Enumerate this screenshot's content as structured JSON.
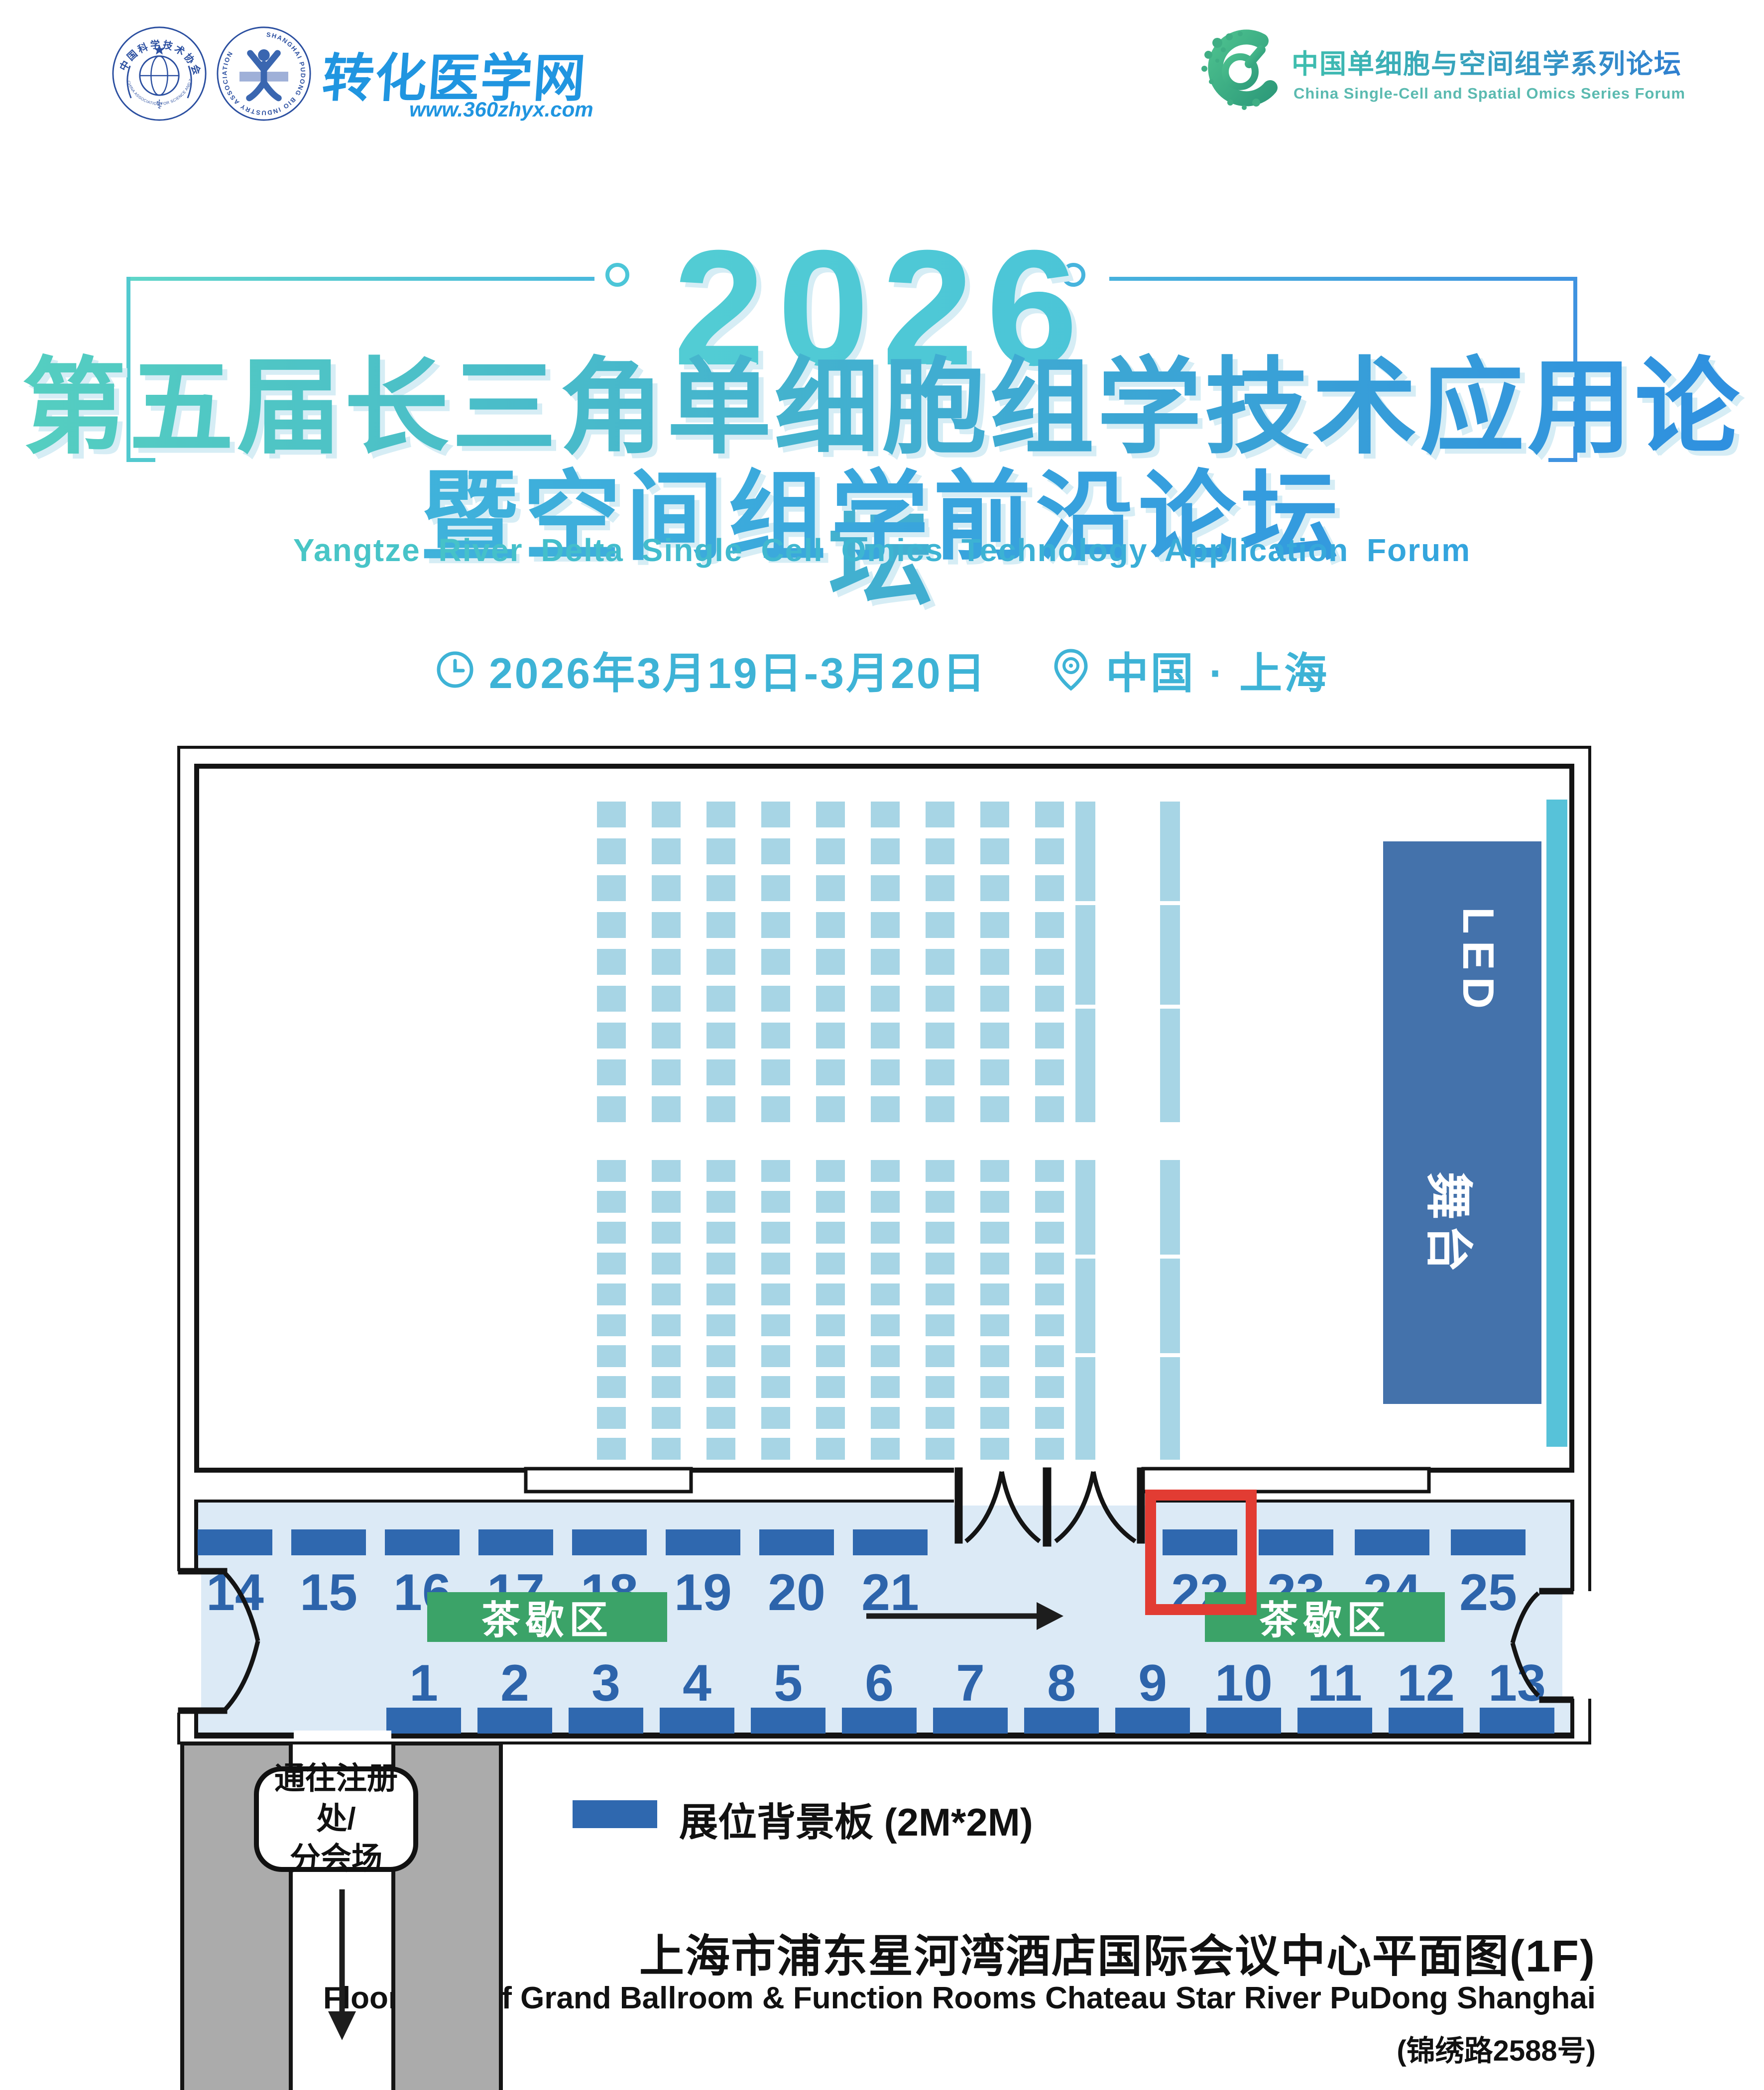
{
  "header": {
    "logo_cast": {
      "ring_cn": "中国科学技术协会",
      "ring_en": "CHINA ASSOCIATION FOR SCIENCE AND TECHNOLOGY"
    },
    "logo_pudong": {
      "ring_en": "SHANGHAI PUDONG BIO INDUSTRY ASSOCIATION"
    },
    "logo_zhyx": {
      "name": "转化医学网",
      "url": "www.360zhyx.com"
    },
    "logo_series": {
      "title_cn": "中国单细胞与空间组学系列论坛",
      "title_en": "China Single-Cell and Spatial Omics Series Forum"
    },
    "year": "2026",
    "title_cn_1": "第五届长三角单细胞组学技术应用论坛",
    "title_cn_2": "暨空间组学前沿论坛",
    "title_en": "Yangtze River Delta Single Cell Omics Technology Application Forum",
    "date": "2026年3月19日-3月20日",
    "location": "中国 · 上海"
  },
  "floorplan": {
    "stage": {
      "led": "LED",
      "name": "舞台"
    },
    "booths_top": [
      "14",
      "15",
      "16",
      "17",
      "18",
      "19",
      "20",
      "21",
      "22",
      "23",
      "24",
      "25"
    ],
    "booths_bottom": [
      "1",
      "2",
      "3",
      "4",
      "5",
      "6",
      "7",
      "8",
      "9",
      "10",
      "11",
      "12",
      "13"
    ],
    "highlighted_booth": "22",
    "tea_area_label": "茶歇区",
    "corridor_label_line1": "通往注册处/",
    "corridor_label_line2": "分会场",
    "legend_label": "展位背景板 (2M*2M)",
    "seating": {
      "columns": 9,
      "front_rows": 9,
      "back_rows": 10,
      "aisle_columns": 2,
      "aisle_segments_per_block": 3
    }
  },
  "footer": {
    "venue_cn": "上海市浦东星河湾酒店国际会议中心平面图(1F)",
    "venue_en": "Floor Plan of Grand Ballroom & Function Rooms Chateau Star River PuDong Shanghai",
    "address": "(锦绣路2588号)"
  },
  "colors": {
    "booth_bar": "#2f68af",
    "booth_number": "#2d64ab",
    "tea_green": "#3ba368",
    "highlight_red": "#e23c33",
    "seat_blue": "#a7d5e5",
    "stage_blue": "#4472ab",
    "screen_cyan": "#57c2d9",
    "hallway_bg": "#dceaf6",
    "title_teal": "#55cfc0",
    "title_blue": "#2e8fe0",
    "date_cyan": "#3eb3d6",
    "logo_blue": "#2095e0"
  }
}
